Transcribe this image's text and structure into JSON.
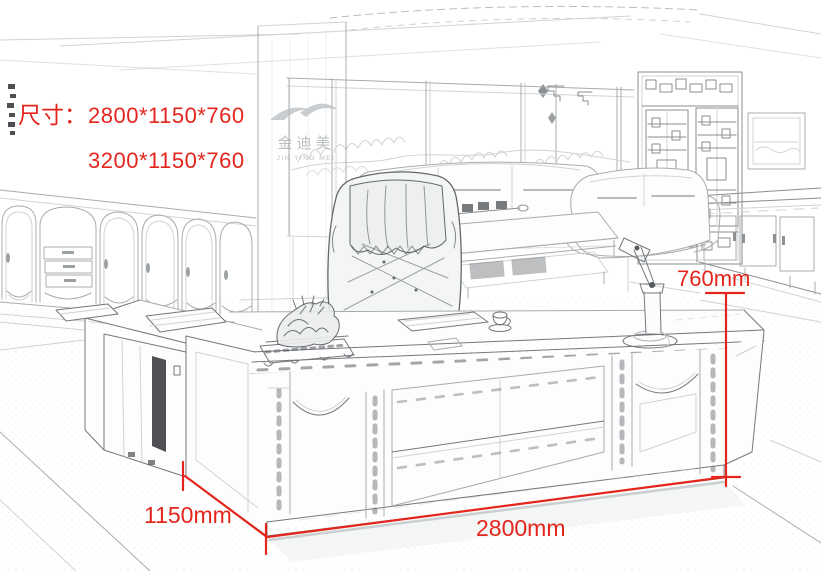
{
  "colors": {
    "background": "#ffffff",
    "dimension_red": "#e3261d",
    "sketch_light": "#cfd3d6",
    "sketch_mid": "#a8acaf",
    "sketch_dark": "#74787c"
  },
  "size_panel": {
    "label": "尺寸：",
    "sizes": [
      "2800*1150*760",
      "3200*1150*760"
    ]
  },
  "measurements": {
    "height": "760mm",
    "depth": "1150mm",
    "width": "2800mm"
  },
  "logo": {
    "cn": "金迪美",
    "en": "JIN YING MEI"
  }
}
